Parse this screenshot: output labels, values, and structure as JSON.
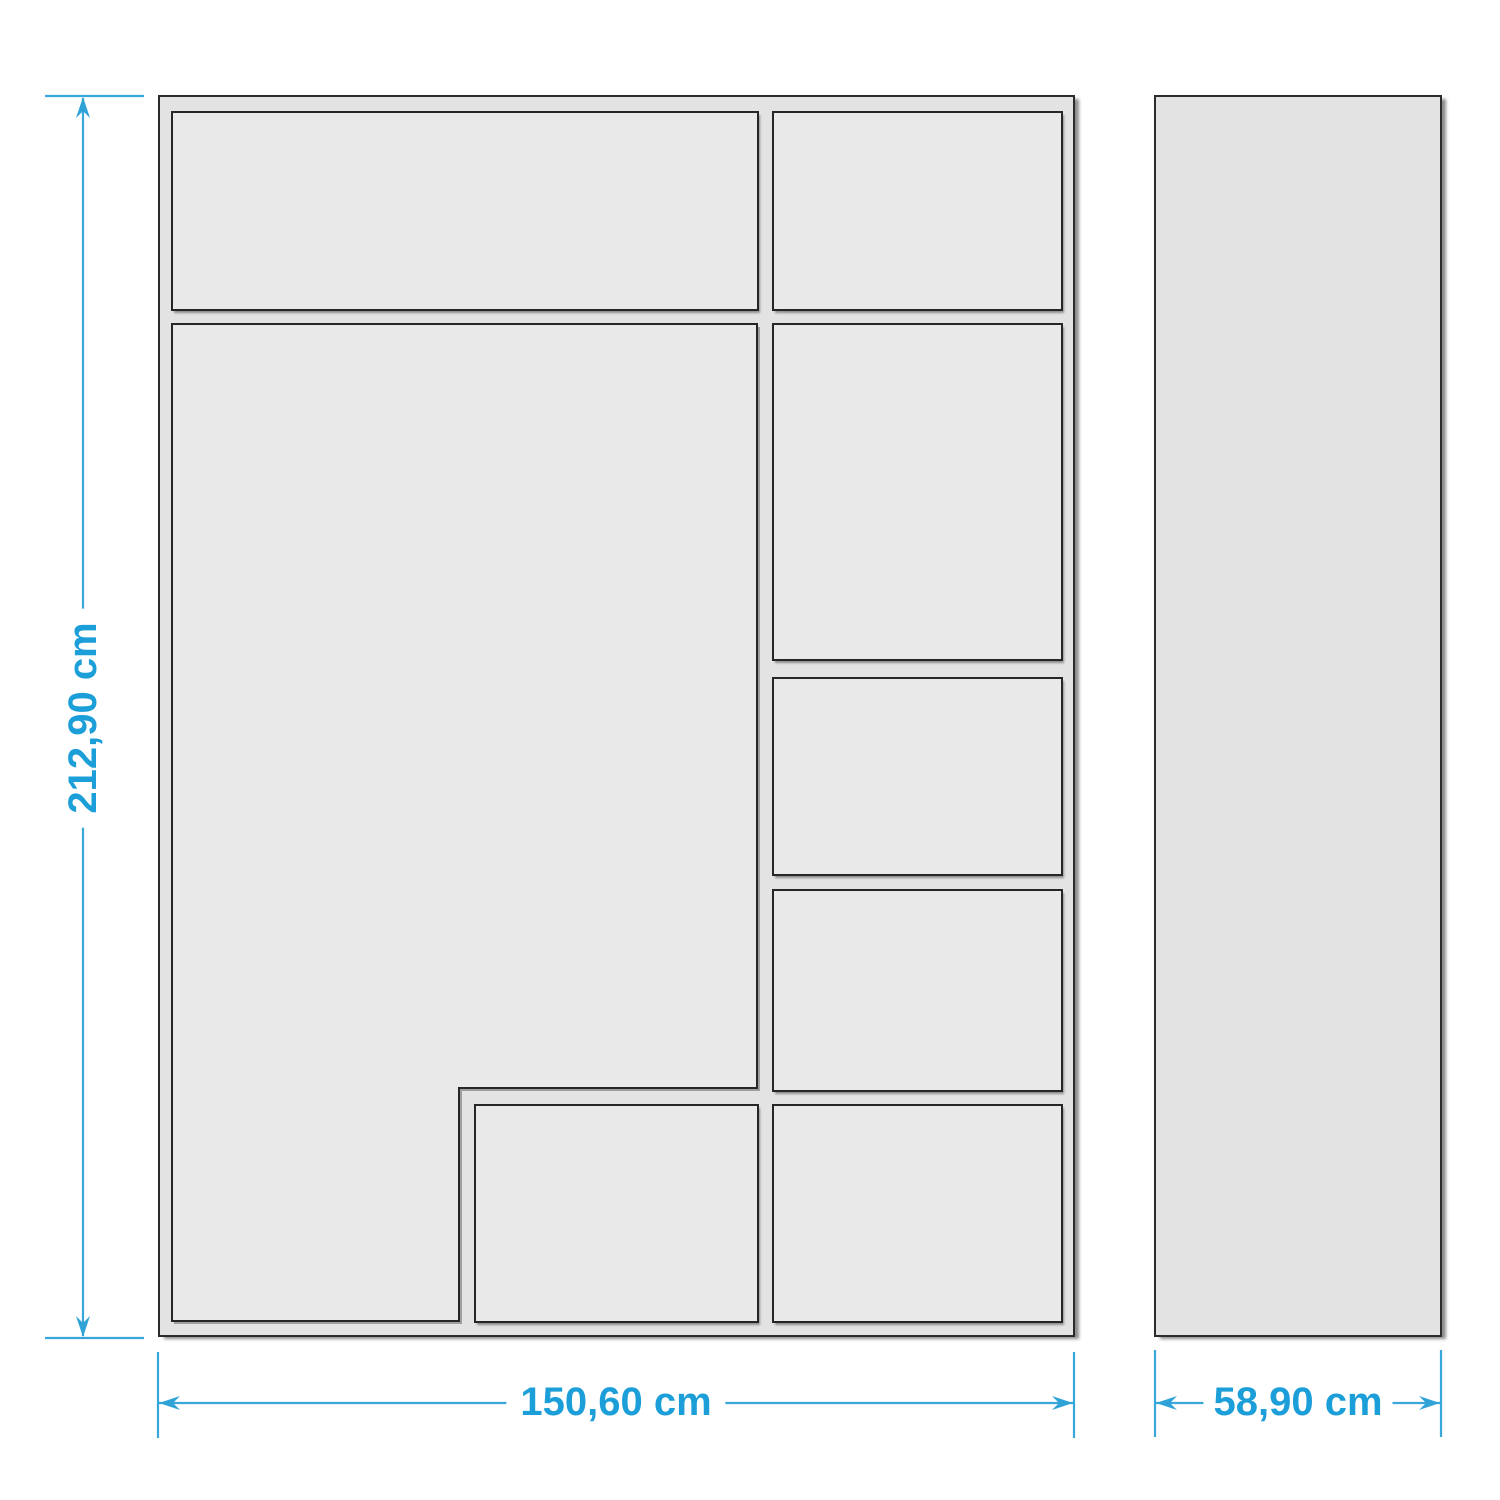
{
  "diagram": {
    "accent_color": "#1c9fd8",
    "outline_color": "#2b2b2b",
    "fill_color": "#e9e9e9",
    "dimensions": {
      "height_label": "212,90 cm",
      "width_label": "150,60 cm",
      "depth_label": "58,90 cm"
    }
  }
}
